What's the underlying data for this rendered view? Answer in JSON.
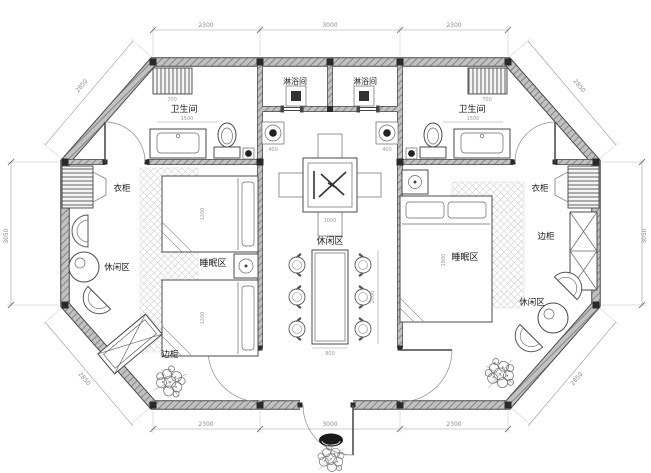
{
  "drawing": {
    "kind": "residential floor plan, octagonal cabin with two bedrooms and central hall"
  },
  "rooms": {
    "bathroom": "卫生间",
    "shower": "淋浴间",
    "wardrobe": "衣柜",
    "side_cabinet": "边柜",
    "sleeping": "睡眠区",
    "leisure": "休闲区"
  },
  "dims": {
    "top": [
      "2300",
      "3000",
      "2300"
    ],
    "bottom": [
      "2300",
      "3000",
      "2300"
    ],
    "side": "3050",
    "diagonal": "2850",
    "interior": [
      "1500",
      "1500",
      "700",
      "700",
      "400",
      "400",
      "800",
      "2000",
      "1200",
      "1200",
      "1800",
      "1000"
    ]
  },
  "colors": {
    "line": "#4a4a4a",
    "wall_fill": "#c2c2c2",
    "wall_hatch": "#8a8a8a",
    "dim_text": "#8a8a8a",
    "label_text": "#1a1a1a",
    "dark_fill": "#2a2a2a",
    "background": "#ffffff"
  }
}
